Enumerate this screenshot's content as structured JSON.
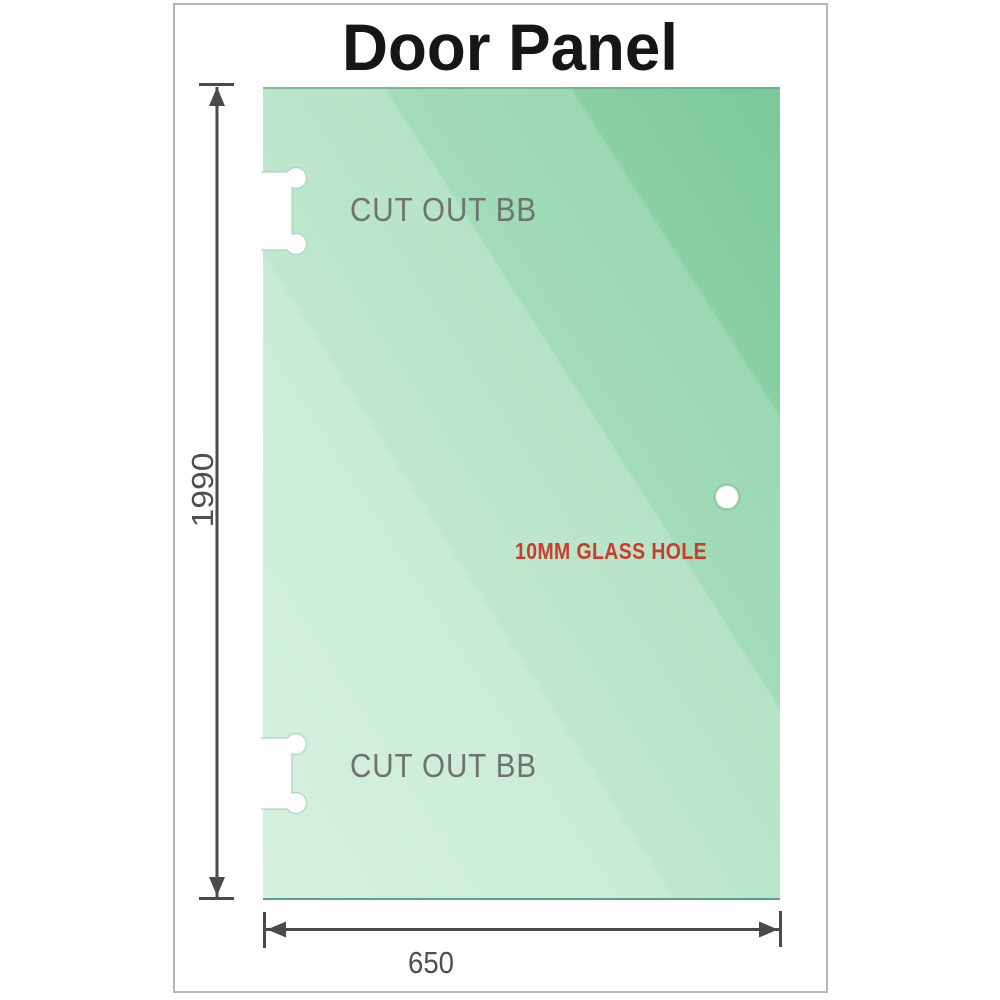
{
  "title": "Door Panel",
  "panel": {
    "cutouts": [
      {
        "label": "CUT OUT BB"
      },
      {
        "label": "CUT OUT BB"
      }
    ],
    "glass_hole_label": "10MM GLASS HOLE"
  },
  "dimensions": {
    "height": "1990",
    "width": "650"
  },
  "colors": {
    "frame_border": "#b5b5b5",
    "title_text": "#161616",
    "dimension_lines": "#4a4a4a",
    "dimension_text": "#4f4f4f",
    "cutout_label_text": "#6e7370",
    "cutout_outline": "#aed3bf",
    "glass_hole_text": "#cc3b2b",
    "glass_hole_ring": "#8fccab",
    "glass_edge_top": "#6fa98c",
    "glass_edge_bottom": "#5da183",
    "glass_gradient": [
      "#7bc79c",
      "#88cfa4",
      "#9bd8b3",
      "#a2dbb8",
      "#b6e3c7",
      "#bfe7cf",
      "#c9ebd6",
      "#d6f1e0"
    ]
  }
}
